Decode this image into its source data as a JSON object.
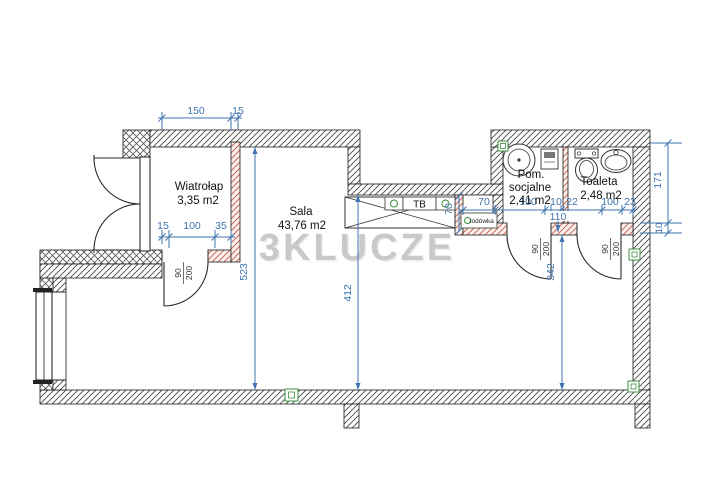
{
  "watermark": "3KLUCZE",
  "rooms": {
    "wiatrolap": {
      "name": "Wiatrołap",
      "area": "3,35 m2"
    },
    "sala": {
      "name": "Sala",
      "area": "43,76 m2"
    },
    "pom": {
      "line1": "Pom.",
      "line2": "socjalne",
      "area": "2,41 m2"
    },
    "toaleta": {
      "name": "Toaleta",
      "area": "2,48 m2"
    }
  },
  "fixtures": {
    "tb": "TB",
    "fridge": "lodówka"
  },
  "dims": {
    "top_width": "150",
    "top_wall": "15",
    "wl_left": "15",
    "wl_door": "100",
    "wl_right": "35",
    "sala_h": "523",
    "sala_h2": "412",
    "right_h": "342",
    "counter_d": "70",
    "fridge_w": "70",
    "pom_w": "100",
    "wall_10": "10",
    "gap_22": "22",
    "toi_w": "100",
    "toi_r": "23",
    "mid": "110",
    "right_171": "171",
    "right_10": "10"
  },
  "doors": [
    {
      "w": "90",
      "h": "200"
    },
    {
      "w": "90",
      "h": "200"
    },
    {
      "w": "90",
      "h": "200"
    }
  ],
  "colors": {
    "dimension": "#3f74ae",
    "wall_hatch": "#4a4a4a",
    "partition_hatch": "#c2604c",
    "symbol_green": "#3f8f3f",
    "watermark": "#c9c9c9"
  }
}
